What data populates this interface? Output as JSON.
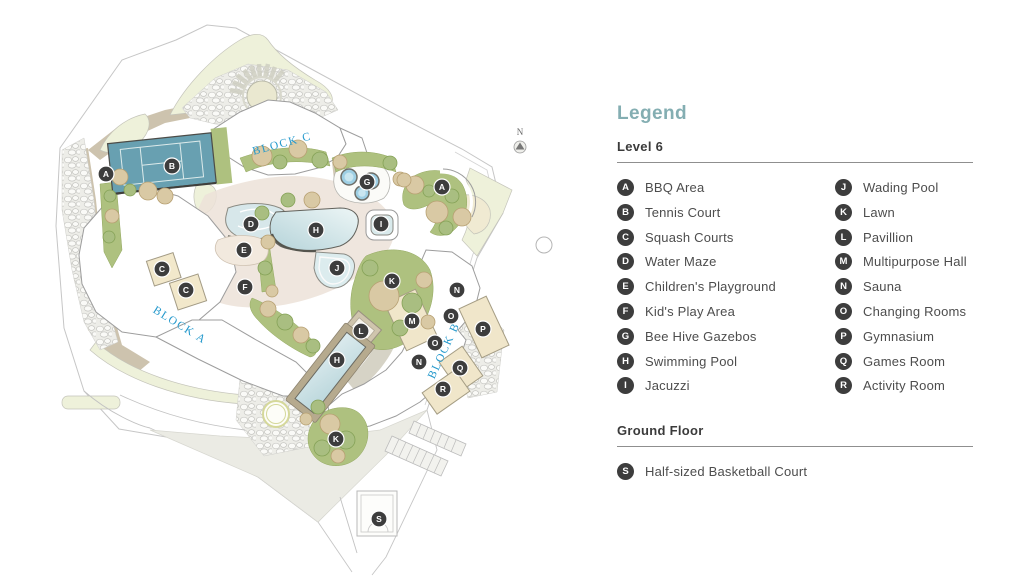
{
  "legend": {
    "title": "Legend",
    "accent_color": "#84aeb2",
    "sections": [
      {
        "title": "Level 6",
        "columns": 2,
        "items": [
          {
            "letter": "A",
            "label": "BBQ Area"
          },
          {
            "letter": "B",
            "label": "Tennis Court"
          },
          {
            "letter": "C",
            "label": "Squash Courts"
          },
          {
            "letter": "D",
            "label": "Water Maze"
          },
          {
            "letter": "E",
            "label": "Children's Playground"
          },
          {
            "letter": "F",
            "label": "Kid's Play Area"
          },
          {
            "letter": "G",
            "label": "Bee Hive Gazebos"
          },
          {
            "letter": "H",
            "label": "Swimming Pool"
          },
          {
            "letter": "I",
            "label": "Jacuzzi"
          },
          {
            "letter": "J",
            "label": "Wading Pool"
          },
          {
            "letter": "K",
            "label": "Lawn"
          },
          {
            "letter": "L",
            "label": "Pavillion"
          },
          {
            "letter": "M",
            "label": "Multipurpose Hall"
          },
          {
            "letter": "N",
            "label": "Sauna"
          },
          {
            "letter": "O",
            "label": "Changing Rooms"
          },
          {
            "letter": "P",
            "label": "Gymnasium"
          },
          {
            "letter": "Q",
            "label": "Games Room"
          },
          {
            "letter": "R",
            "label": "Activity Room"
          }
        ]
      },
      {
        "title": "Ground Floor",
        "columns": 1,
        "items": [
          {
            "letter": "S",
            "label": "Half-sized Basketball Court"
          }
        ]
      }
    ]
  },
  "map": {
    "compass_label": "N",
    "label_color": "#2599cc",
    "marker_fill": "#3d3d3d",
    "marker_text_color": "#ffffff",
    "block_labels": [
      {
        "text": "BLOCK C",
        "x": 283,
        "y": 147,
        "rotation": -15
      },
      {
        "text": "BLOCK A",
        "x": 178,
        "y": 328,
        "rotation": 32
      },
      {
        "text": "BLOCK B",
        "x": 447,
        "y": 352,
        "rotation": -65
      }
    ],
    "markers": [
      {
        "letter": "A",
        "x": 106,
        "y": 174
      },
      {
        "letter": "B",
        "x": 172,
        "y": 166
      },
      {
        "letter": "A",
        "x": 442,
        "y": 187
      },
      {
        "letter": "G",
        "x": 367,
        "y": 182
      },
      {
        "letter": "D",
        "x": 251,
        "y": 224
      },
      {
        "letter": "I",
        "x": 381,
        "y": 224
      },
      {
        "letter": "H",
        "x": 316,
        "y": 230
      },
      {
        "letter": "E",
        "x": 244,
        "y": 250
      },
      {
        "letter": "J",
        "x": 337,
        "y": 268
      },
      {
        "letter": "C",
        "x": 162,
        "y": 269
      },
      {
        "letter": "K",
        "x": 392,
        "y": 281
      },
      {
        "letter": "F",
        "x": 245,
        "y": 287
      },
      {
        "letter": "C",
        "x": 186,
        "y": 290
      },
      {
        "letter": "N",
        "x": 457,
        "y": 290
      },
      {
        "letter": "O",
        "x": 451,
        "y": 316
      },
      {
        "letter": "M",
        "x": 412,
        "y": 321
      },
      {
        "letter": "P",
        "x": 483,
        "y": 329
      },
      {
        "letter": "L",
        "x": 361,
        "y": 331
      },
      {
        "letter": "O",
        "x": 435,
        "y": 343
      },
      {
        "letter": "H",
        "x": 337,
        "y": 360
      },
      {
        "letter": "N",
        "x": 419,
        "y": 362
      },
      {
        "letter": "Q",
        "x": 460,
        "y": 368
      },
      {
        "letter": "R",
        "x": 443,
        "y": 389
      },
      {
        "letter": "K",
        "x": 336,
        "y": 439
      },
      {
        "letter": "S",
        "x": 379,
        "y": 519
      }
    ]
  }
}
